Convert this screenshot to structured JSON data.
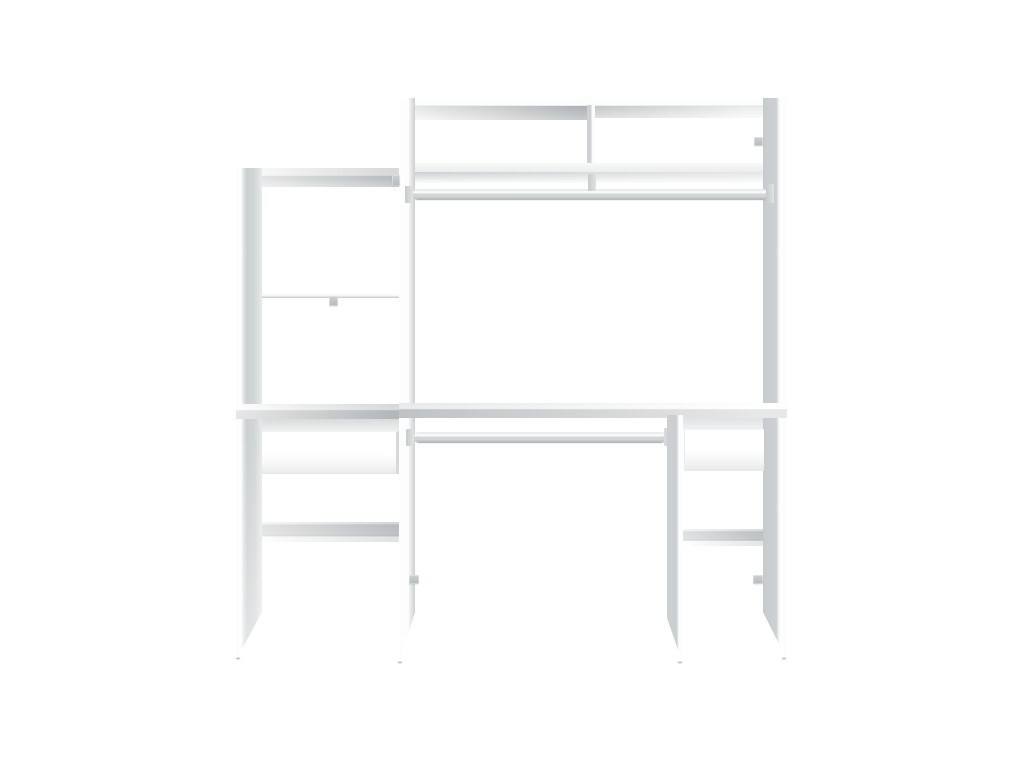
{
  "image": {
    "type": "product-photo",
    "alt": "White open wardrobe storage system with two chrome hanging rails, open shelves, two top compartments and two drawers, on a plain white background",
    "background": "#ffffff"
  },
  "product": {
    "finish_color_name": "white",
    "components": {
      "hanging_rails": 2,
      "drawers": 2,
      "top_compartments": 2,
      "shelf_levels": 6,
      "vertical_panels": 4
    }
  },
  "colors": {
    "background": "#ffffff",
    "panel_white": "#fcfdfd",
    "face_gray": "#ccd0d2",
    "shadow_gray": "#cbd0d2",
    "chrome_light": "#f8f9f9",
    "chrome_mid": "#d2d6d7",
    "chrome_dark": "#aeb4b6",
    "fitting_gray": "#b5babc",
    "contact_shadow": "#55585a"
  }
}
